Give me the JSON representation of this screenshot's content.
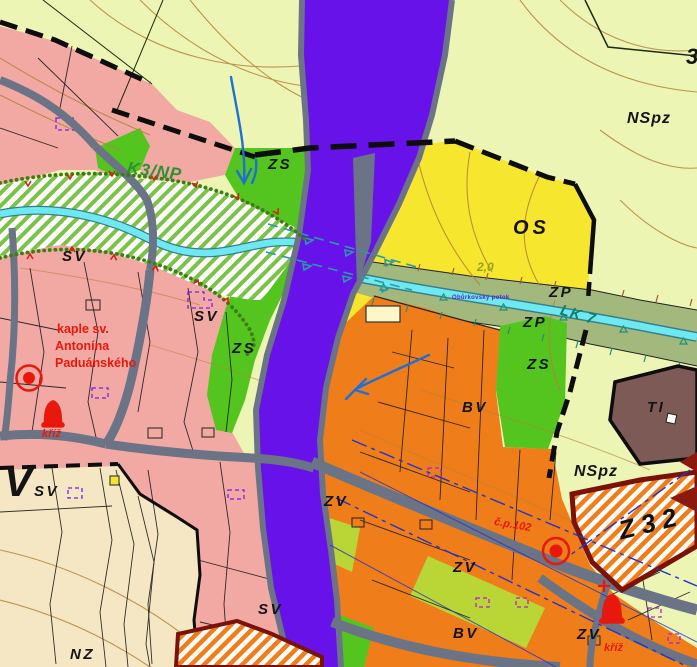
{
  "map": {
    "zones": {
      "sv": "SV",
      "bv": "BV",
      "zv": "ZV",
      "zs": "ZS",
      "zp": "ZP",
      "os": "OS",
      "nz": "NZ",
      "ti": "TI",
      "nspz": "NSpz",
      "v_large": "V",
      "v_sub": "SV"
    },
    "codes": {
      "k3np": "K3/NP",
      "lk7": "LK 7",
      "z32": "Z32",
      "os_capacity": "2,0",
      "edge_parcel": "3",
      "house_number": "č.p.102"
    },
    "notes": {
      "chapel": [
        "kaple sv.",
        "Antonína",
        "Paduánského"
      ],
      "cross": "kříž",
      "stream": "Obůrkovský potok"
    },
    "colors": {
      "pale_nspz": "#edf5b5",
      "residential_pink": "#f2a9a4",
      "village_orange": "#ef7d1a",
      "corridor_purple": "#6812ea",
      "green": "#54c41e",
      "chartreuse": "#b9d636",
      "yellow_os": "#f6e72e",
      "beige_nz": "#f5e7c3",
      "band_olive": "#a3b87c",
      "stream_cyan": "#6ee9f2",
      "road_gray": "#6b7386",
      "ti_brown": "#7d5a55",
      "border_darkred": "#7a1208",
      "symbol_red": "#e8180c",
      "arrow_blue": "#1e6fd6"
    }
  }
}
